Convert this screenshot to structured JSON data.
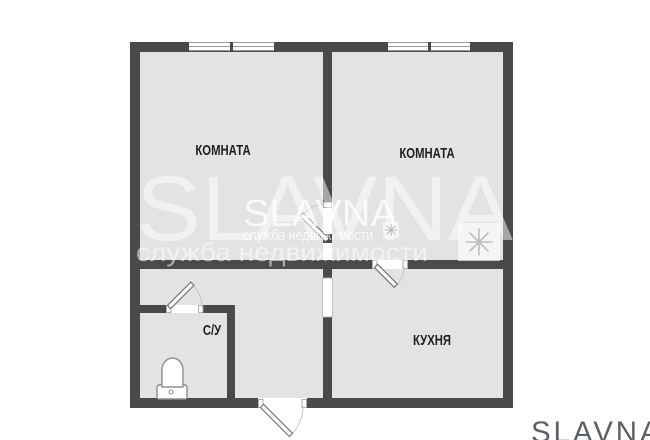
{
  "plan": {
    "rooms": [
      {
        "name": "room-left",
        "label": "КОМНАТА"
      },
      {
        "name": "room-right",
        "label": "КОМНАТА"
      },
      {
        "name": "kitchen",
        "label": "КУХНЯ"
      },
      {
        "name": "bathroom",
        "label": "С/У"
      }
    ],
    "window_count": 2,
    "door_count": 4,
    "fixtures": [
      "toilet"
    ]
  },
  "watermark": {
    "brand_large": "SLAVNA",
    "tagline_large": "служба недвижимости",
    "brand_small": "SLAVNA",
    "tagline_small": "служба недвижимости"
  },
  "footer": {
    "logo_text": "SLAVNA"
  },
  "colors": {
    "wall": "#4a4a4c",
    "floor": "#e3e3e5",
    "background": "#ffffff",
    "label_text": "#1f1f1f",
    "logo_text": "#5b6066",
    "door_outline": "#77777b",
    "arc": "#c6c6ca",
    "watermark": "#ffffff"
  }
}
